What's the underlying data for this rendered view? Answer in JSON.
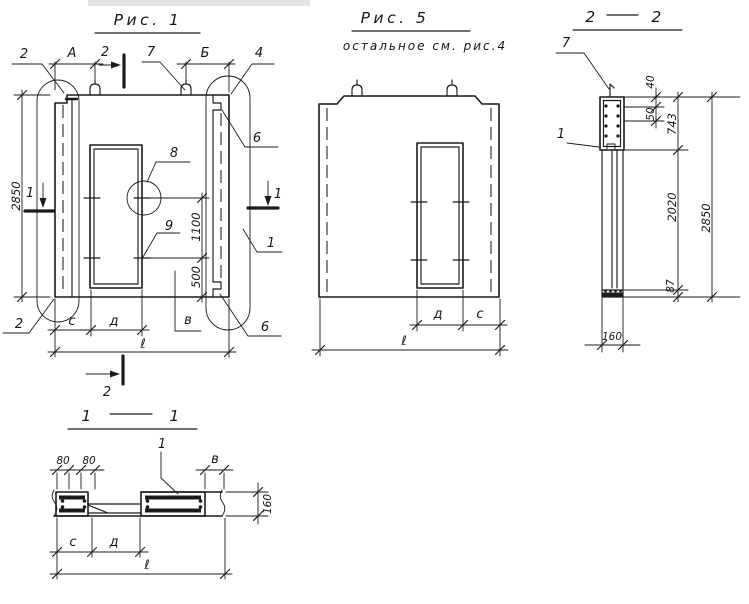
{
  "colors": {
    "ink": "#1b1b1b",
    "paper": "#ffffff"
  },
  "fig1": {
    "title": "Рис. 1",
    "labels": {
      "callout2Top": "2",
      "dimA": "А",
      "section2Top": "2",
      "callout7": "7",
      "dimB": "Б",
      "callout4": "4",
      "callout6Top": "6",
      "section1Left": "1",
      "section1Right": "1",
      "callout1Right": "1",
      "callout8": "8",
      "callout9": "9",
      "callout6Bottom": "6",
      "callout2Bottom": "2",
      "dim2850": "2850",
      "dim1100": "1100",
      "dim500": "500",
      "dimC": "с",
      "dimD": "д",
      "labelV": "в",
      "dimL": "ℓ",
      "section2Bottom": "2"
    }
  },
  "fig5": {
    "title": "Рис. 5",
    "subtitle": "остальное  см. рис.4",
    "labels": {
      "dimD": "д",
      "dimC": "с",
      "dimL": "ℓ"
    }
  },
  "sec22": {
    "titleLeft": "2",
    "titleRight": "2",
    "labels": {
      "callout7": "7",
      "callout1": "1",
      "dim40": "40",
      "dim50": "50",
      "dim743": "743",
      "dim2020": "2020",
      "dim2850": "2850",
      "dim87": "87",
      "dim160": "160"
    }
  },
  "sec11": {
    "titleLeft": "1",
    "titleRight": "1",
    "labels": {
      "dim80a": "80",
      "dim80b": "80",
      "callout1": "1",
      "dimV": "в",
      "dim160": "160",
      "dimC": "с",
      "dimD": "д",
      "dimL": "ℓ"
    }
  }
}
